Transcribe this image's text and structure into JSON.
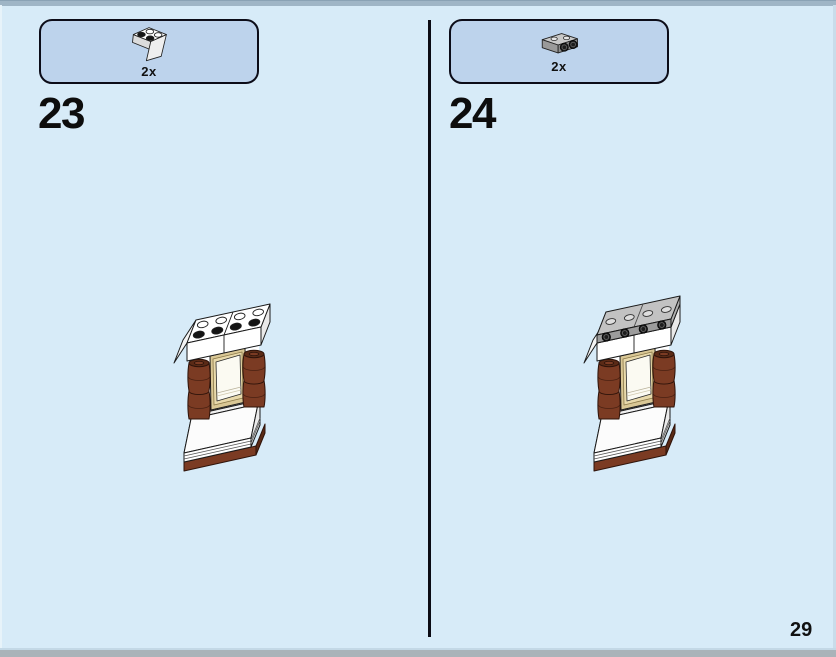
{
  "page": {
    "number": "29",
    "background_color": "#d7ebf8",
    "top_edge_color": "#9fb5c6",
    "bottom_edge_color": "#aab3b9"
  },
  "steps": [
    {
      "number": "23",
      "parts_callout": {
        "quantity": "2x",
        "part_icon": "white-2x2-inverted-slope-brick",
        "box_fill": "#bdd3ec",
        "box_border": "#0c0c18"
      },
      "illustration": "window-wall-assembly-with-white-slope-cornice"
    },
    {
      "number": "24",
      "parts_callout": {
        "quantity": "2x",
        "part_icon": "silver-1x2-plate-with-two-side-studs",
        "box_fill": "#bdd3ec",
        "box_border": "#0c0c18"
      },
      "illustration": "window-wall-assembly-with-silver-side-stud-plates-added"
    }
  ],
  "brick_colors": {
    "white": "#ffffff",
    "reddish_brown": "#7b3b23",
    "reddish_brown_dark": "#5a2a16",
    "tan": "#d9c795",
    "silver_gray": "#9c9c9c",
    "stud_dark": "#1d1d1d"
  }
}
